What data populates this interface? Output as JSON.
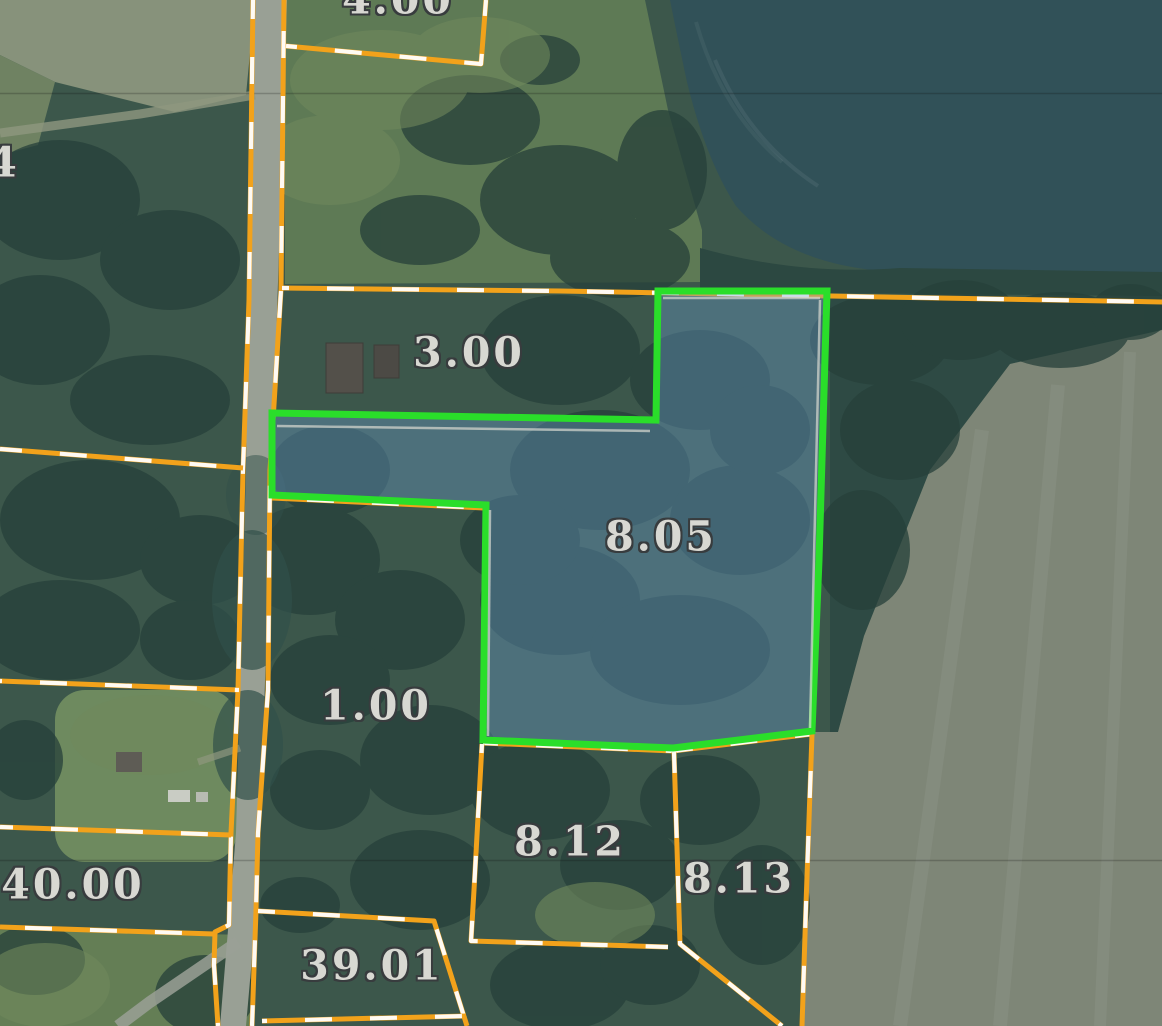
{
  "map": {
    "type": "county-parcel-viewer-aerial",
    "selected_parcel": "8.05",
    "labels": [
      {
        "text": "4.00",
        "x": 398,
        "y": 0,
        "note": "clipped-top"
      },
      {
        "text": "4",
        "x": 4,
        "y": 163,
        "note": "clipped-left"
      },
      {
        "text": "3.00",
        "x": 469,
        "y": 353
      },
      {
        "text": "8.05",
        "x": 661,
        "y": 537
      },
      {
        "text": "1.00",
        "x": 376,
        "y": 706
      },
      {
        "text": "8.12",
        "x": 570,
        "y": 842
      },
      {
        "text": "8.13",
        "x": 739,
        "y": 879
      },
      {
        "text": "40.00",
        "x": 73,
        "y": 885
      },
      {
        "text": "39.01",
        "x": 372,
        "y": 966
      }
    ],
    "colors": {
      "parcel_line": "#F2A21B",
      "parcel_line_dash": "#FFFFFF",
      "highlight_stroke": "#2ADE2A",
      "highlight_fill": "rgba(110,160,215,0.35)",
      "label_text": "#D8D8D2",
      "label_outline": "#383C3E"
    }
  }
}
